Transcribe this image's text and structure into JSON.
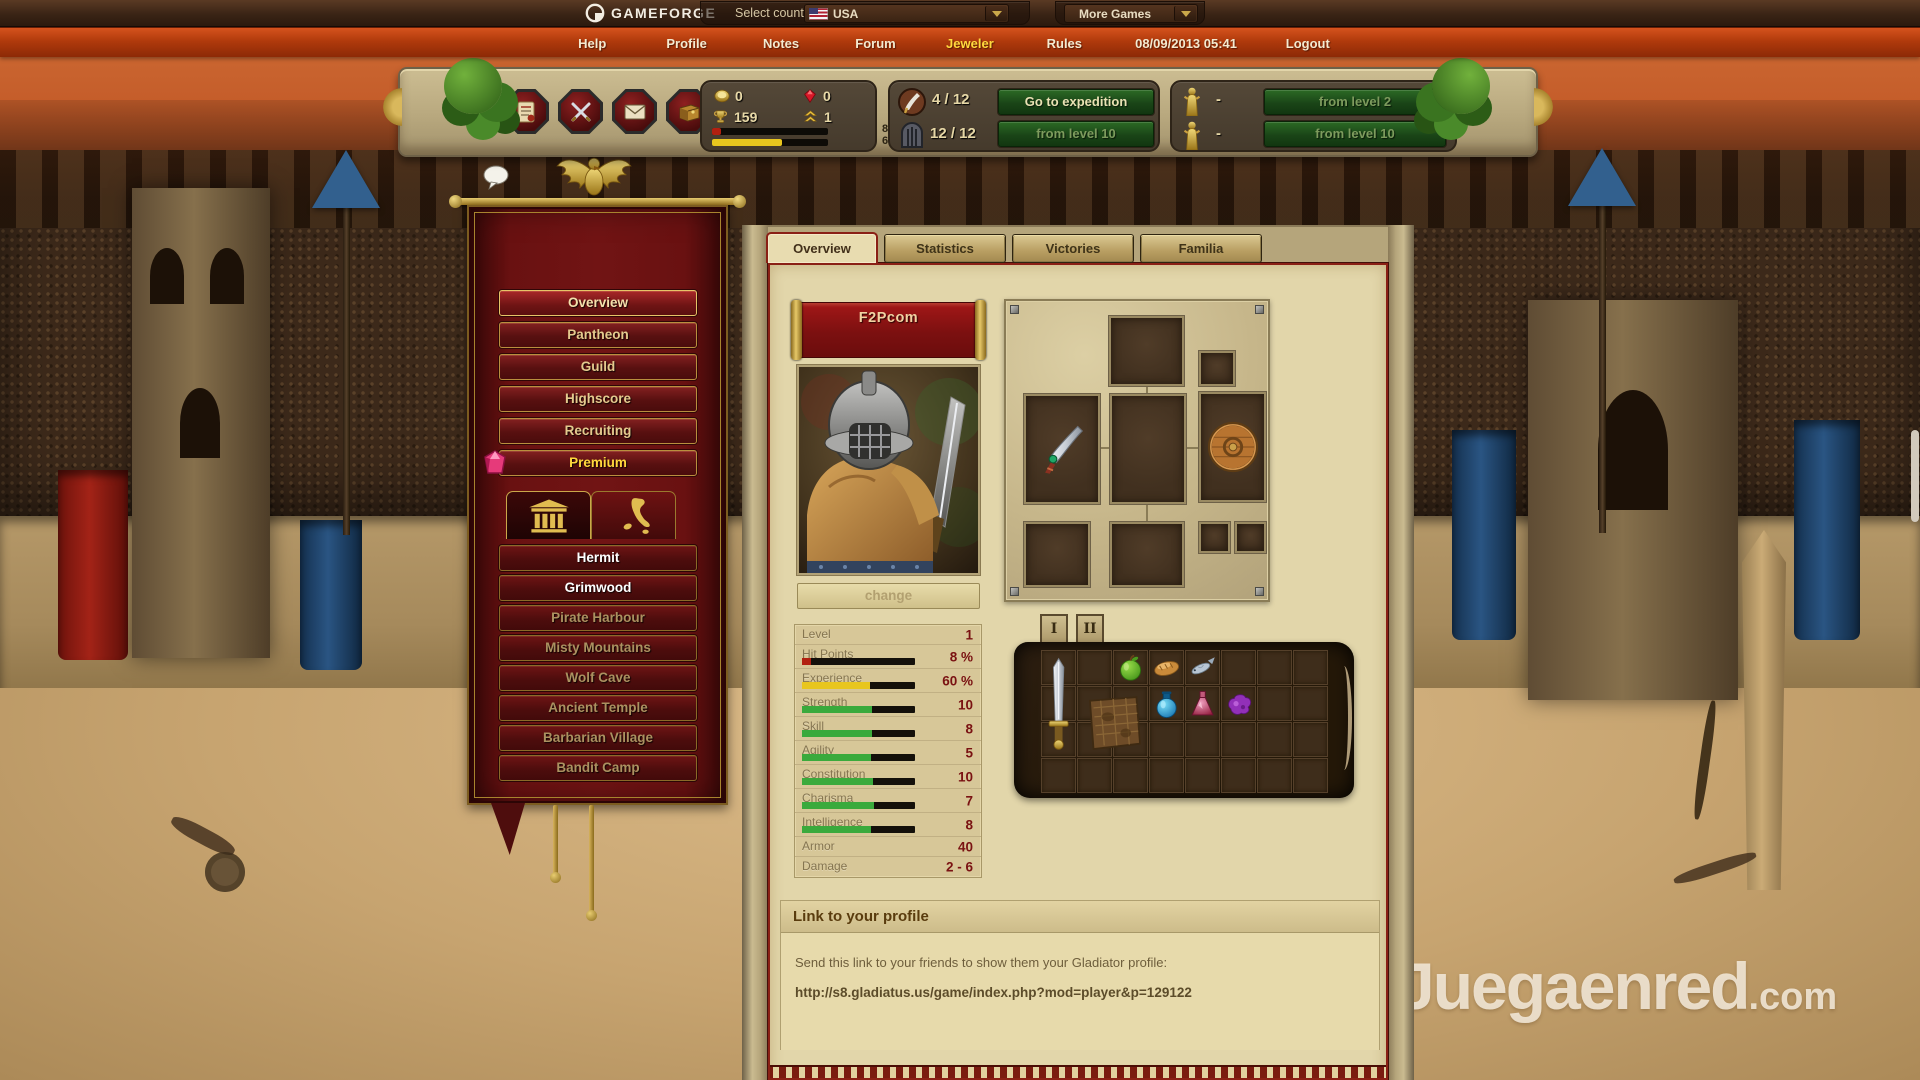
{
  "topbar": {
    "brand": "GAMEFORGE",
    "select_country_label": "Select country:",
    "country_value": "USA",
    "more_games_label": "More Games"
  },
  "navbar": {
    "items": [
      {
        "label": "Help"
      },
      {
        "label": "Profile"
      },
      {
        "label": "Notes"
      },
      {
        "label": "Forum"
      },
      {
        "label": "Jeweler",
        "active": true
      },
      {
        "label": "Rules"
      }
    ],
    "datetime": "08/09/2013 05:41",
    "logout_label": "Logout",
    "highlight_color": "#ffd93e"
  },
  "header": {
    "action_icons": [
      "report-icon",
      "combat-icon",
      "messages-icon",
      "packages-icon"
    ],
    "resources": {
      "gold": "0",
      "rubies": "0",
      "trophies": "159",
      "rank": "1",
      "hp_label": "8%",
      "xp_label": "60%",
      "hp_fill": 8,
      "xp_fill": 60,
      "hp_color": "#b22010",
      "xp_color": "#e8c61e"
    },
    "expedition": {
      "points": "4 / 12",
      "go_button": "Go to expedition",
      "dungeon_points": "12 / 12",
      "dungeon_button": "from level 10"
    },
    "arena": {
      "slot1_value": "-",
      "slot1_button": "from level 2",
      "slot2_value": "-",
      "slot2_button": "from level 10"
    }
  },
  "sidebar": {
    "menu": [
      {
        "label": "Overview",
        "active": true
      },
      {
        "label": "Pantheon"
      },
      {
        "label": "Guild"
      },
      {
        "label": "Highscore"
      },
      {
        "label": "Recruiting"
      },
      {
        "label": "Premium",
        "premium": true
      }
    ],
    "location_tabs": [
      {
        "name": "city-tab",
        "icon": "temple-icon",
        "active": true
      },
      {
        "name": "map-tab",
        "icon": "map-icon"
      }
    ],
    "locations": [
      {
        "label": "Hermit",
        "unlocked": true
      },
      {
        "label": "Grimwood",
        "unlocked": true
      },
      {
        "label": "Pirate Harbour"
      },
      {
        "label": "Misty Mountains"
      },
      {
        "label": "Wolf Cave"
      },
      {
        "label": "Ancient Temple"
      },
      {
        "label": "Barbarian Village"
      },
      {
        "label": "Bandit Camp"
      }
    ]
  },
  "main": {
    "tabs": [
      {
        "label": "Overview",
        "active": true
      },
      {
        "label": "Statistics"
      },
      {
        "label": "Victories"
      },
      {
        "label": "Familia"
      }
    ],
    "character": {
      "name": "F2Pcom",
      "change_label": "change"
    },
    "stats": {
      "rows": [
        {
          "label": "Level",
          "value": "1"
        },
        {
          "label": "Hit Points",
          "value": "8 %",
          "fill": 8,
          "color": "#b22010"
        },
        {
          "label": "Experience",
          "value": "60 %",
          "fill": 60,
          "color": "#e8c61e"
        },
        {
          "label": "Strength",
          "value": "10",
          "fill": 62,
          "color": "#3aaa3c"
        },
        {
          "label": "Skill",
          "value": "8",
          "fill": 62,
          "color": "#3aaa3c"
        },
        {
          "label": "Agility",
          "value": "5",
          "fill": 61,
          "color": "#3aaa3c"
        },
        {
          "label": "Constitution",
          "value": "10",
          "fill": 63,
          "color": "#3aaa3c"
        },
        {
          "label": "Charisma",
          "value": "7",
          "fill": 64,
          "color": "#3aaa3c"
        },
        {
          "label": "Intelligence",
          "value": "8",
          "fill": 61,
          "color": "#3aaa3c"
        },
        {
          "label": "Armor",
          "value": "40"
        },
        {
          "label": "Damage",
          "value": "2 - 6"
        }
      ]
    },
    "equipment": {
      "items": [
        {
          "slot": "weapon-slot",
          "icon": "curved-dagger-icon"
        },
        {
          "slot": "shield-slot",
          "icon": "round-shield-icon"
        }
      ]
    },
    "inventory": {
      "tabs": [
        "I",
        "II"
      ],
      "items": [
        {
          "name": "sword",
          "col": 0,
          "row": 0,
          "w": 1,
          "h": 3
        },
        {
          "name": "apple",
          "col": 2,
          "row": 0,
          "w": 1,
          "h": 1
        },
        {
          "name": "bread",
          "col": 3,
          "row": 0,
          "w": 1,
          "h": 1
        },
        {
          "name": "fish",
          "col": 4,
          "row": 0,
          "w": 1,
          "h": 1
        },
        {
          "name": "chain-armor",
          "col": 1,
          "row": 1,
          "w": 2,
          "h": 2
        },
        {
          "name": "blue-potion",
          "col": 3,
          "row": 1,
          "w": 1,
          "h": 1
        },
        {
          "name": "red-potion",
          "col": 4,
          "row": 1,
          "w": 1,
          "h": 1
        },
        {
          "name": "purple-item",
          "col": 5,
          "row": 1,
          "w": 1,
          "h": 1
        }
      ]
    },
    "profile_link": {
      "title": "Link to your profile",
      "description": "Send this link to your friends to show them your Gladiator profile:",
      "url": "http://s8.gladiatus.us/game/index.php?mod=player&p=129122"
    }
  },
  "watermark": {
    "text": "Juegaenred",
    "tld": ".com"
  }
}
